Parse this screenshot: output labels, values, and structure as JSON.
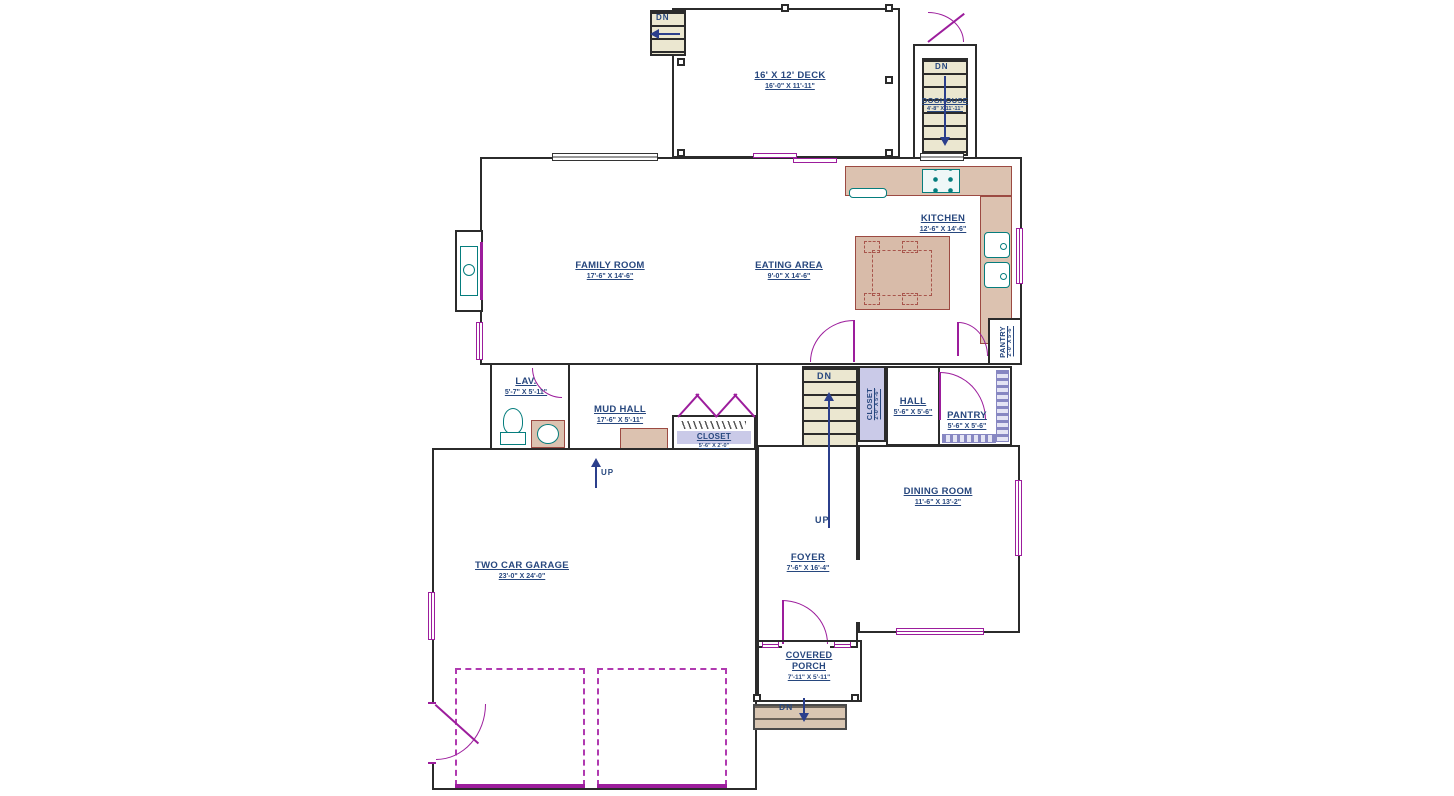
{
  "palette": {
    "label_blue": "#27477e",
    "door_purple": "#9c1d9c",
    "fixture_teal": "#057d7d",
    "counter_tan": "#dcc2b0",
    "counter_edge": "#9c4a42",
    "stair_beige": "#ebe7d0",
    "shelf_lavender": "#cacae8",
    "arrow_blue": "#2b3f8c",
    "wall_black": "#2b2b2b"
  },
  "rooms": {
    "deck": {
      "name": "16' X 12' DECK",
      "dims": "16'-0\" X 11'-11\""
    },
    "doghouse": {
      "name": "DOGHOUSE",
      "dims": "4'-8\" X 11'-11\""
    },
    "family_room": {
      "name": "FAMILY ROOM",
      "dims": "17'-6\" X 14'-6\""
    },
    "eating_area": {
      "name": "EATING AREA",
      "dims": "9'-0\" X 14'-6\""
    },
    "kitchen": {
      "name": "KITCHEN",
      "dims": "12'-6\" X 14'-6\""
    },
    "pantry_upper": {
      "name": "PANTRY",
      "dims": "2'-0\" X 5'-6\""
    },
    "lav": {
      "name": "LAV.",
      "dims": "5'-7\" X 5'-11\""
    },
    "mud_hall": {
      "name": "MUD HALL",
      "dims": "17'-6\" X 5'-11\""
    },
    "mud_closet": {
      "name": "CLOSET",
      "dims": "5'-6\" X 2'-0\""
    },
    "stair_closet": {
      "name": "CLOSET",
      "dims": "2'-0\" X 5'-6\""
    },
    "hall": {
      "name": "HALL",
      "dims": "5'-6\" X 5'-6\""
    },
    "pantry_lower": {
      "name": "PANTRY",
      "dims": "5'-6\" X 5'-6\""
    },
    "dining_room": {
      "name": "DINING ROOM",
      "dims": "11'-6\" X 13'-2\""
    },
    "foyer": {
      "name": "FOYER",
      "dims": "7'-6\" X 16'-4\""
    },
    "garage": {
      "name": "TWO CAR GARAGE",
      "dims": "23'-0\" X 24'-0\""
    },
    "covered_porch": {
      "name": "COVERED PORCH",
      "dims": "7'-11\" X 5'-11\""
    }
  },
  "stairs": {
    "deck_landing": "DN",
    "doghouse": "DN",
    "main_top": "DN",
    "main_bottom": "UP",
    "mud_stairs": "UP",
    "porch_steps": "DN"
  }
}
